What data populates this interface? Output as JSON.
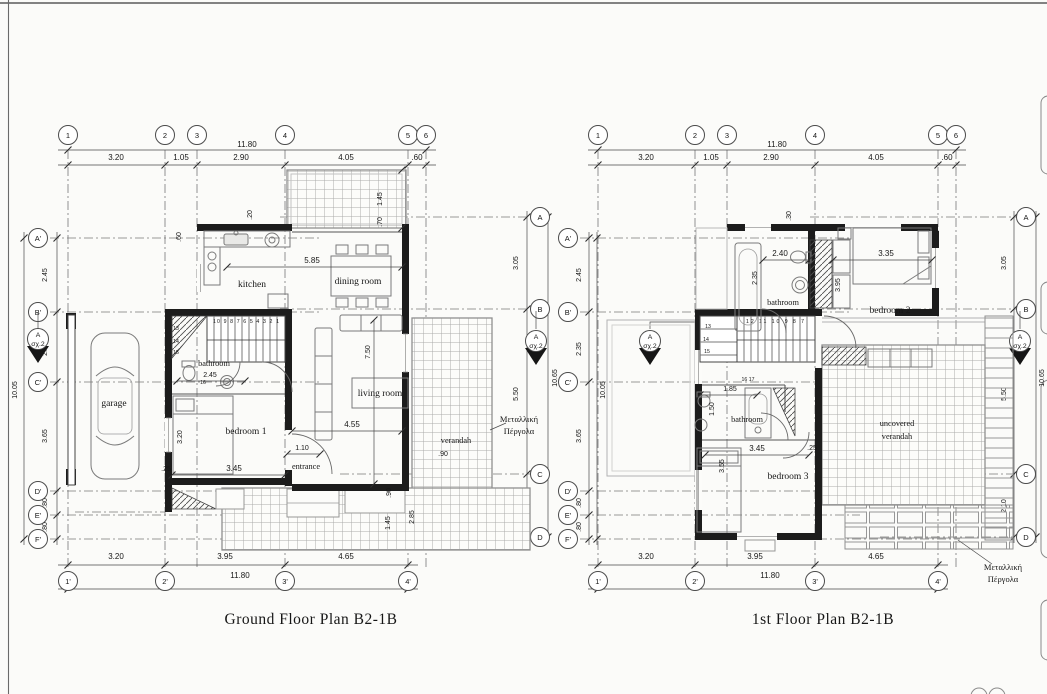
{
  "sheet": {
    "ground_title": "Ground Floor Plan  B2-1B",
    "first_title": "1st Floor Plan  B2-1B",
    "pergola_line1": "Μεταλλική",
    "pergola_line2": "Πέργολα",
    "section_marker": {
      "letter": "A",
      "ref": "σχ.2"
    }
  },
  "grid": {
    "top": {
      "bubbles": [
        "1",
        "2",
        "3",
        "4",
        "5",
        "6"
      ],
      "dims": [
        "3.20",
        "1.05",
        "2.90",
        "4.05",
        ".60"
      ],
      "total": "11.80"
    },
    "bottom": {
      "bubbles": [
        "1'",
        "2'",
        "3'",
        "4'"
      ],
      "dims": [
        "3.20",
        "3.95",
        "4.65"
      ],
      "total": "11.80"
    },
    "left": {
      "bubbles": [
        "A'",
        "B'",
        "C'",
        "D'",
        "E'",
        "F'"
      ],
      "dims": [
        "2.45",
        "2.35",
        "3.65",
        ".80",
        ".80"
      ],
      "total": "10.05"
    },
    "right": {
      "bubbles": [
        "A",
        "B",
        "C",
        "D"
      ],
      "dims": [
        "3.05",
        "5.50",
        "2.10"
      ],
      "total": "10.65"
    }
  },
  "ground": {
    "rooms": {
      "kitchen": "kitchen",
      "dining": "dining room",
      "living": "living room",
      "bedroom1": "bedroom 1",
      "bathroom": "bathroom",
      "garage": "garage",
      "entrance": "entrance",
      "verandah": "verandah"
    },
    "dims": {
      "d585": "5.85",
      "d750": "7.50",
      "d455": "4.55",
      "d345": "3.45",
      "v320": "3.20",
      "d245": "2.45",
      "d110": "1.10",
      "d090": ".90",
      "v090": ".90",
      "v145_top": "1.45",
      "v070": ".70",
      "v145_bot": "1.45",
      "v285": "2.85",
      "v060": ".60",
      "v020": ".20",
      "d025": ".25"
    },
    "stairs": {
      "run": "10 9 8 7 6 5 4 3 2 1",
      "n13": "13",
      "n14": "14",
      "n15": "15",
      "n16": "16"
    }
  },
  "first": {
    "rooms": {
      "bathroom1": "bathroom",
      "bedroom2": "bedroom 2",
      "bathroom2": "bathroom",
      "bedroom3": "bedroom 3",
      "verandah1": "uncovered",
      "verandah2": "verandah"
    },
    "dims": {
      "d240": "2.40",
      "v235": "2.35",
      "v395": "3.95",
      "d335": "3.35",
      "v030": ".30",
      "d185": "1.85",
      "v150": "1.50",
      "d345": "3.45",
      "v355": "3.55",
      "d025": ".25"
    },
    "stairs": {
      "run": "12 11 10 9 8 7",
      "n13": "13",
      "n14": "14",
      "n15": "15",
      "n1617": "16 17"
    }
  }
}
